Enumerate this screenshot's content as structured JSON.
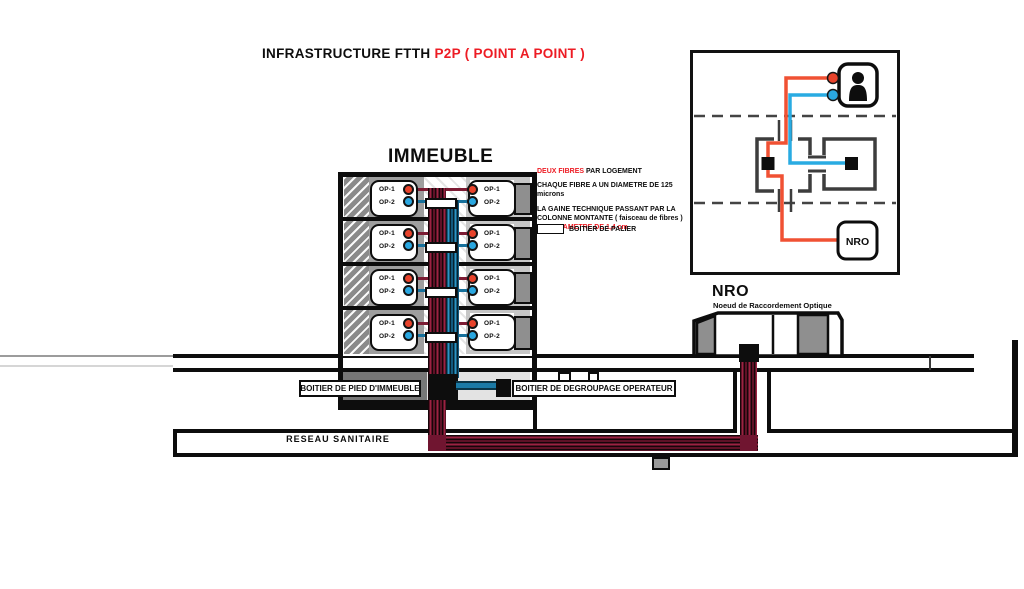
{
  "title": {
    "prefix": "INFRASTRUCTURE FTTH ",
    "highlight": "P2P ( POINT A POINT )"
  },
  "building": {
    "label": "IMMEUBLE",
    "floors": [
      {
        "left": {
          "op1": "OP-1",
          "op2": "OP-2"
        },
        "right": {
          "op1": "OP-1",
          "op2": "OP-2"
        }
      },
      {
        "left": {
          "op1": "OP-1",
          "op2": "OP-2"
        },
        "right": {
          "op1": "OP-1",
          "op2": "OP-2"
        }
      },
      {
        "left": {
          "op1": "OP-1",
          "op2": "OP-2"
        },
        "right": {
          "op1": "OP-1",
          "op2": "OP-2"
        }
      },
      {
        "left": {
          "op1": "OP-1",
          "op2": "OP-2"
        },
        "right": {
          "op1": "OP-1",
          "op2": "OP-2"
        }
      }
    ]
  },
  "notes": {
    "line1_red": "DEUX FIBRES",
    "line1_black": " PAR LOGEMENT",
    "line2": "CHAQUE FIBRE A UN DIAMETRE DE 125 microns",
    "line3a": "LA GAINE TECHNIQUE PASSANT PAR LA",
    "line3b": "COLONNE MONTANTE ( faisceau de fibres )",
    "line3c_black": "A UN ",
    "line3c_red": "DIAMETRE DE 1,4 cm",
    "legend_label": "BOITIER DE PALIER"
  },
  "basement": {
    "building_box_label": "BOITIER DE PIED D'IMMEUBLE",
    "operator_box_label": "BOITIER DE DEGROUPAGE OPERATEUR"
  },
  "duct": {
    "label": "RESEAU SANITAIRE"
  },
  "nro": {
    "title": "NRO",
    "subtitle": "Noeud de Raccordement Optique"
  },
  "inset": {
    "nro_label": "NRO"
  },
  "colors": {
    "accent_red": "#ed1c24",
    "fiber_red": "#f05133",
    "fiber_blue": "#29abe2",
    "op1_dot": "#e8432b",
    "op2_dot": "#2aa7e0",
    "riser_red": "#7c1b33",
    "riser_blue": "#17719c",
    "cable_maroon": "#701530"
  }
}
